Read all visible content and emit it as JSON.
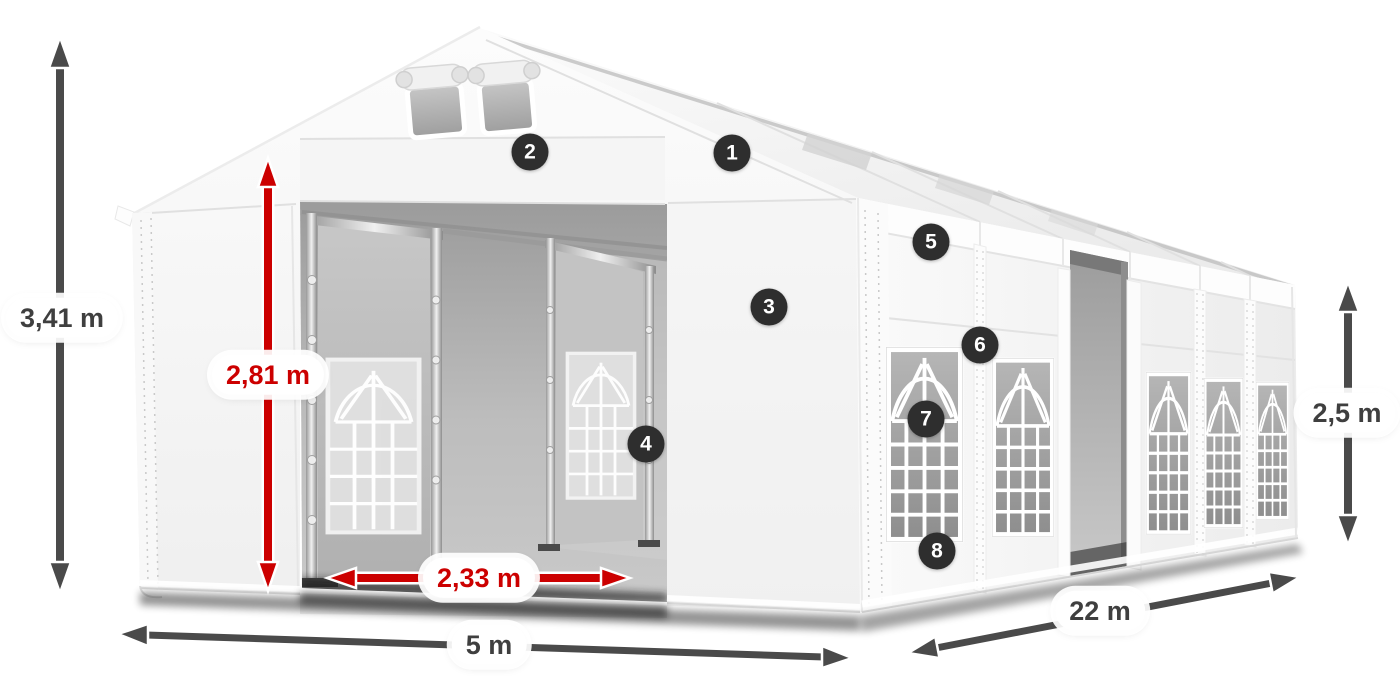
{
  "dimensions": {
    "total_height": "3,41 m",
    "entrance_height": "2,81 m",
    "entrance_width": "2,33 m",
    "width": "5 m",
    "length": "22 m",
    "side_height": "2,5 m"
  },
  "markers": [
    "1",
    "2",
    "3",
    "4",
    "5",
    "6",
    "7",
    "8"
  ],
  "colors": {
    "dimension_red": "#cc0000",
    "dimension_dark": "#4a4a4a",
    "marker_background": "#2e2e2e",
    "marker_text": "#ffffff",
    "tent_white": "#f7f7f7",
    "interior_gray": "#a8a8a8"
  }
}
